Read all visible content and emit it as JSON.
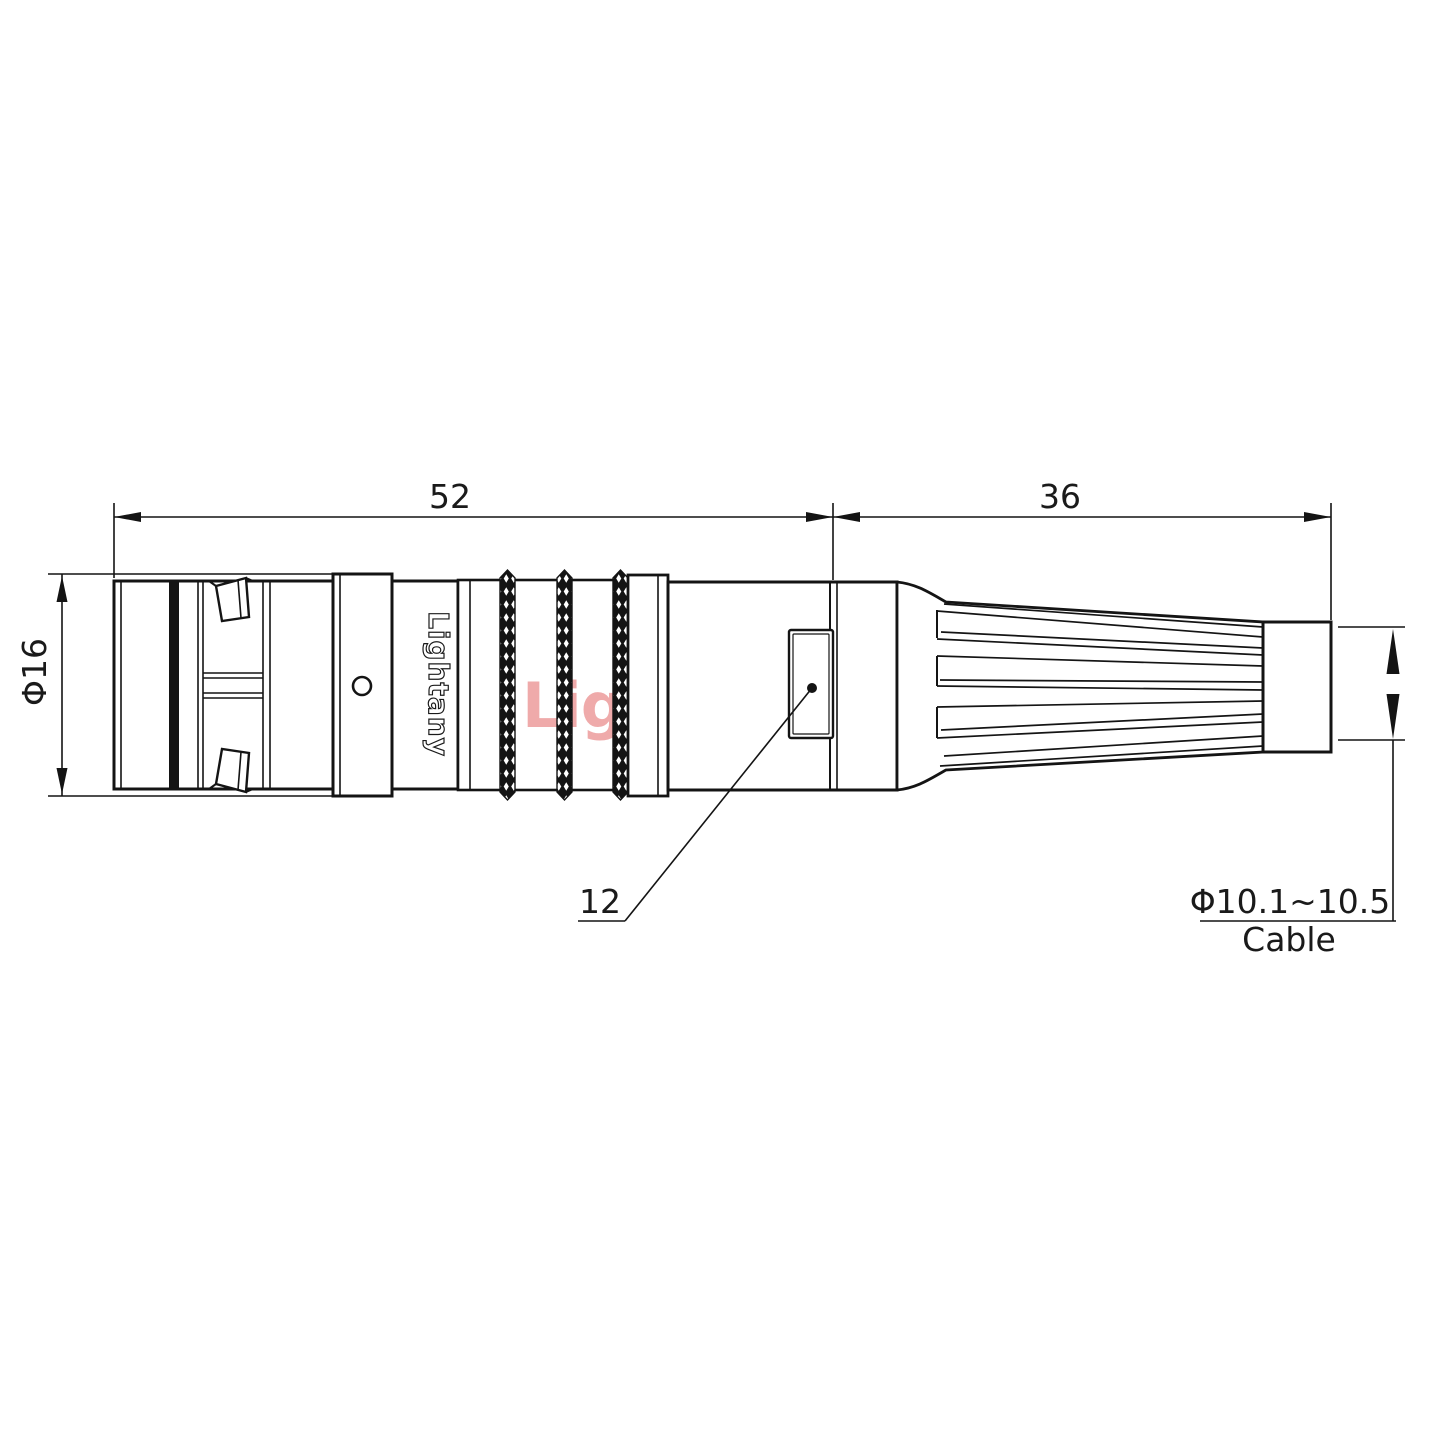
{
  "page": {
    "background": "#ffffff",
    "line_color": "#141414"
  },
  "watermark": {
    "text": "Lightany",
    "color": "#eb9595"
  },
  "part": {
    "logo_text": "Lightany"
  },
  "dimensions": {
    "front_length": "52",
    "rear_length": "36",
    "body_diameter": "Φ16",
    "latch_ref": "12",
    "cable_range": "Φ10.1~10.5",
    "cable_label": "Cable"
  }
}
